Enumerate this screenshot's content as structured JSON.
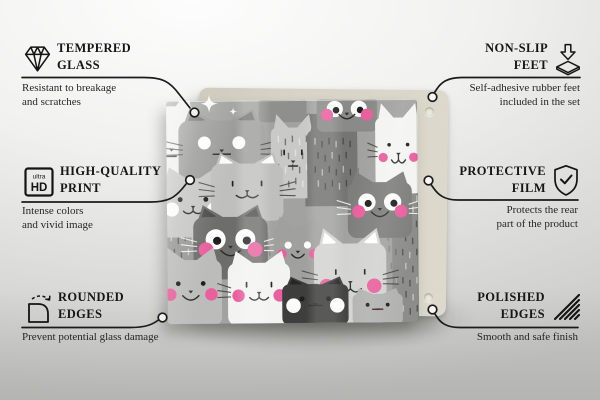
{
  "page": {
    "type_label": "glass board product infographic",
    "background_top": "#fbfbfb",
    "background_bottom": "#c8c8c6"
  },
  "callouts": [
    {
      "id": "tempered-glass",
      "icon": "diamond-icon",
      "title_line1": "TEMPERED",
      "title_line2": "GLASS",
      "desc_line1": "Resistant to breakage",
      "desc_line2": "and scratches"
    },
    {
      "id": "high-quality-print",
      "icon": "ultra-hd-icon",
      "title_line1": "HIGH-QUALITY",
      "title_line2": "PRINT",
      "desc_line1": "Intense colors",
      "desc_line2": "and vivid image"
    },
    {
      "id": "rounded-edges",
      "icon": "rounded-corner-arrow-icon",
      "title_line1": "ROUNDED",
      "title_line2": "EDGES",
      "desc_line1": "Prevent potential glass damage",
      "desc_line2": ""
    },
    {
      "id": "non-slip-feet",
      "icon": "rubber-foot-arrow-icon",
      "title_line1": "NON-SLIP",
      "title_line2": "FEET",
      "desc_line1": "Self-adhesive rubber feet",
      "desc_line2": "included in the set"
    },
    {
      "id": "protective-film",
      "icon": "shield-check-icon",
      "title_line1": "PROTECTIVE",
      "title_line2": "FILM",
      "desc_line1": "Protects the rear",
      "desc_line2": "part of the product"
    },
    {
      "id": "polished-edges",
      "icon": "diagonal-hatch-icon",
      "title_line1": "POLISHED",
      "title_line2": "EDGES",
      "desc_line1": "Smooth and safe finish",
      "desc_line2": ""
    }
  ],
  "ultra_hd_icon": {
    "top_text": "ultra",
    "main_text": "HD"
  },
  "product": {
    "description": "Rectangular glass print of cartoon cats in grey, white and charcoal tones with pink cheeks and ears, standing in front of a beige backing board fitted with two round rubber feet",
    "backing_color": "#d7d3c6",
    "feet_color": "#ebe8dd",
    "pattern": {
      "background": "#a2a2a0",
      "pink": "#ea5f9e",
      "texture_blocks": [
        {
          "x": 138,
          "y": 14,
          "w": 52,
          "h": 92,
          "color": "#757573"
        },
        {
          "x": 224,
          "y": 88,
          "w": 34,
          "h": 138,
          "color": "#8d8d8b"
        },
        {
          "x": 0,
          "y": 128,
          "w": 28,
          "h": 46,
          "color": "#979795"
        }
      ],
      "cats": [
        {
          "x": -18,
          "y": -12,
          "w": 46,
          "h": 108,
          "color": "#efefed",
          "eyes": "dot",
          "cheeks": "pink",
          "mouth": "line",
          "whiskers": true
        },
        {
          "x": 12,
          "y": 8,
          "w": 86,
          "h": 74,
          "color": "#9b9b99",
          "eyes": "dotwhite",
          "mouth": "line",
          "whiskers": true,
          "earInner": "#767674"
        },
        {
          "x": 92,
          "y": -6,
          "w": 48,
          "h": 28,
          "color": "#8f8f8d",
          "earInner": "#f05c9c"
        },
        {
          "x": 104,
          "y": 14,
          "w": 44,
          "h": 84,
          "color": "#c9c9c7",
          "eyes": "dash",
          "stripes": true,
          "mouth": "line"
        },
        {
          "x": 140,
          "y": 16,
          "w": 50,
          "h": 88,
          "color": "#757573",
          "stripes": true
        },
        {
          "x": 150,
          "y": -10,
          "w": 60,
          "h": 42,
          "color": "#8a8a88",
          "eyes": "bigwhite",
          "cheeks": "pink",
          "mouth": "smile"
        },
        {
          "x": 208,
          "y": 4,
          "w": 46,
          "h": 90,
          "color": "#f4f4f2",
          "eyes": "dot",
          "cheeks": "pink",
          "mouth": "w",
          "whiskers": true
        },
        {
          "x": -6,
          "y": 66,
          "w": 64,
          "h": 70,
          "color": "#c6c6c4",
          "eyes": "dot",
          "cheeks": "white",
          "mouth": "w",
          "whiskers": true
        },
        {
          "x": 44,
          "y": 52,
          "w": 72,
          "h": 68,
          "color": "#bfbfbd",
          "eyes": "dash",
          "mouth": "w",
          "whiskers": true,
          "earInner": "#fbfbfb"
        },
        {
          "x": 228,
          "y": 92,
          "w": 30,
          "h": 132,
          "color": "#8d8d8b",
          "stripes": true
        },
        {
          "x": 180,
          "y": 72,
          "w": 64,
          "h": 66,
          "color": "#7e7e7c",
          "eyes": "bigwhite",
          "cheeks": "pink",
          "mouth": "smile",
          "whiskers": true
        },
        {
          "x": 26,
          "y": 104,
          "w": 74,
          "h": 74,
          "color": "#6d6d6b",
          "eyes": "bigwhite",
          "cheeks": "pink",
          "mouth": "smile",
          "whiskers": true,
          "earInner": "#4d4d4b"
        },
        {
          "x": 106,
          "y": 116,
          "w": 48,
          "h": 62,
          "color": "#a0a09e",
          "eyes": "dotwhite",
          "cheeks": "pink",
          "mouth": "smile"
        },
        {
          "x": -8,
          "y": 146,
          "w": 62,
          "h": 78,
          "color": "#bcbcba",
          "eyes": "dot",
          "cheeks": "pink",
          "mouth": "smile"
        },
        {
          "x": 60,
          "y": 150,
          "w": 62,
          "h": 74,
          "color": "#f3f3f1",
          "eyes": "dash",
          "cheeks": "pink",
          "mouth": "w",
          "whiskers": true
        },
        {
          "x": 146,
          "y": 128,
          "w": 72,
          "h": 96,
          "color": "#d3d3d1",
          "eyes": "dash",
          "cheeks": "pink",
          "mouth": "w",
          "whiskers": true,
          "earInner": "#ffffff"
        },
        {
          "x": 114,
          "y": 176,
          "w": 66,
          "h": 48,
          "color": "#3e3e3c",
          "eyes": "dot",
          "cheeks": "white",
          "mouth": "line",
          "earInner": "#262624"
        },
        {
          "x": 184,
          "y": 188,
          "w": 50,
          "h": 36,
          "color": "#b2b2b0",
          "eyes": "dot",
          "mouth": "line",
          "nosePink": true
        }
      ]
    }
  }
}
